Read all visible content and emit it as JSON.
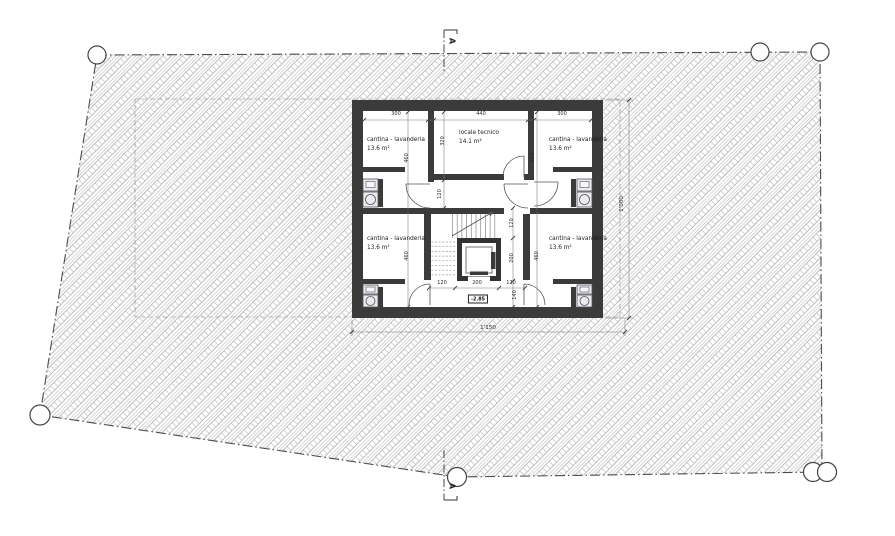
{
  "rooms": {
    "top_left": {
      "name": "cantina - lavanderia",
      "area": "13.6 m²"
    },
    "top_middle": {
      "name": "locale tecnico",
      "area": "14.1 m²"
    },
    "top_right": {
      "name": "cantina - lavanderia",
      "area": "13.6 m²"
    },
    "bottom_left": {
      "name": "cantina - lavanderia",
      "area": "13.6 m²"
    },
    "bottom_right": {
      "name": "cantina - lavanderia",
      "area": "13.6 m²"
    }
  },
  "dimensions": {
    "top_room_left_width": "300",
    "technical_room_width": "440",
    "top_room_right_width": "300",
    "room_depth_top_left": "460",
    "room_depth_top_right": "460",
    "room_depth_bottom_left": "460",
    "room_depth_bottom_right": "460",
    "technical_room_depth": "320",
    "corridor_width": "120",
    "stair_depth": "120",
    "lift_depth": "200",
    "lobby_depth": "140",
    "lobby_left_width": "120",
    "lift_width": "200",
    "lobby_right_width": "120",
    "building_width": "1'150",
    "building_depth": "1'000"
  },
  "levels": {
    "floor_elevation": "-2.85"
  },
  "section": {
    "label_top": "A",
    "label_bottom": "A"
  },
  "colors": {
    "wall": "#3b3b3b",
    "hatch_line": "#b0b0b0",
    "boundary": "#555555"
  }
}
